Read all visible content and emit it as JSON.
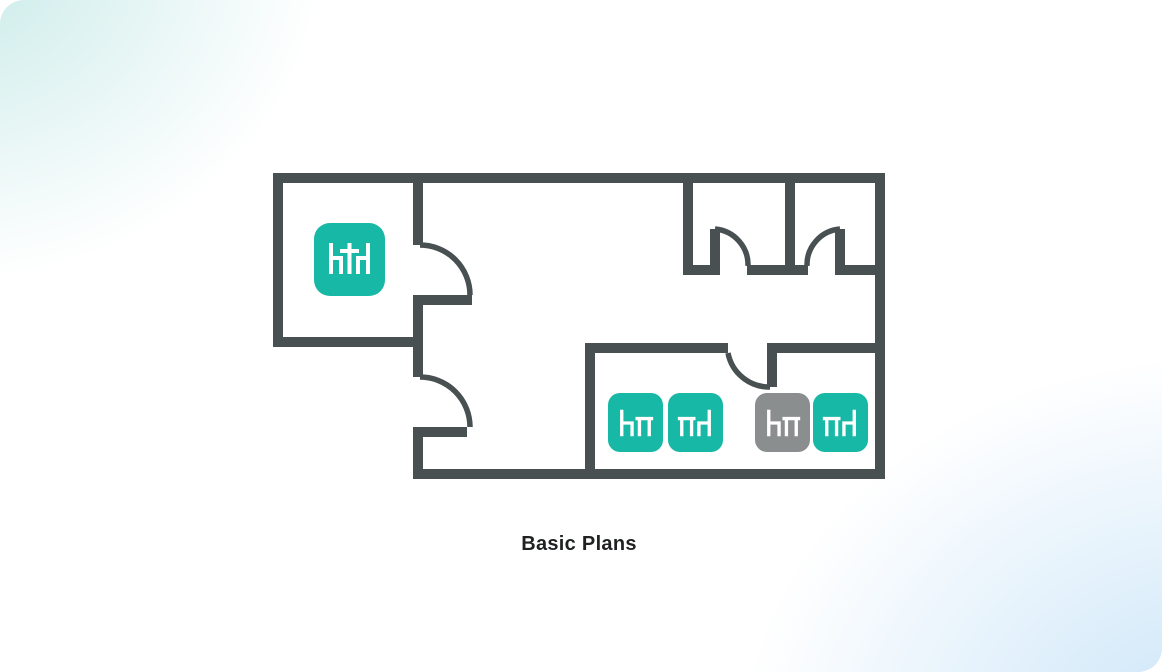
{
  "page": {
    "caption": "Basic Plans"
  },
  "colors": {
    "wall": "#485052",
    "seat_available": "#17b8a5",
    "seat_unavailable": "#8b8e8f",
    "glyph": "#ffffff",
    "glow_top_left": "#c7eae8",
    "glow_bottom_right": "#c9e4f8",
    "caption_text": "#1f2122"
  },
  "floor_plan": {
    "rooms": [
      {
        "name": "top-left-room"
      },
      {
        "name": "top-right-room-1"
      },
      {
        "name": "top-right-room-2"
      },
      {
        "name": "bottom-right-room"
      },
      {
        "name": "hallway"
      }
    ],
    "door_count": 5,
    "icons": [
      {
        "id": "table-two-chairs",
        "room": "top-left-room",
        "glyph": "chair-table-chair",
        "variant": "teal",
        "color_hex": "#17b8a5"
      },
      {
        "id": "seat-1",
        "room": "bottom-right-room",
        "glyph": "chair-table",
        "variant": "teal",
        "color_hex": "#17b8a5"
      },
      {
        "id": "seat-2",
        "room": "bottom-right-room",
        "glyph": "table-chair",
        "variant": "teal",
        "color_hex": "#17b8a5"
      },
      {
        "id": "seat-3",
        "room": "bottom-right-room",
        "glyph": "chair-table",
        "variant": "gray",
        "color_hex": "#8b8e8f"
      },
      {
        "id": "seat-4",
        "room": "bottom-right-room",
        "glyph": "table-chair",
        "variant": "teal",
        "color_hex": "#17b8a5"
      }
    ]
  }
}
